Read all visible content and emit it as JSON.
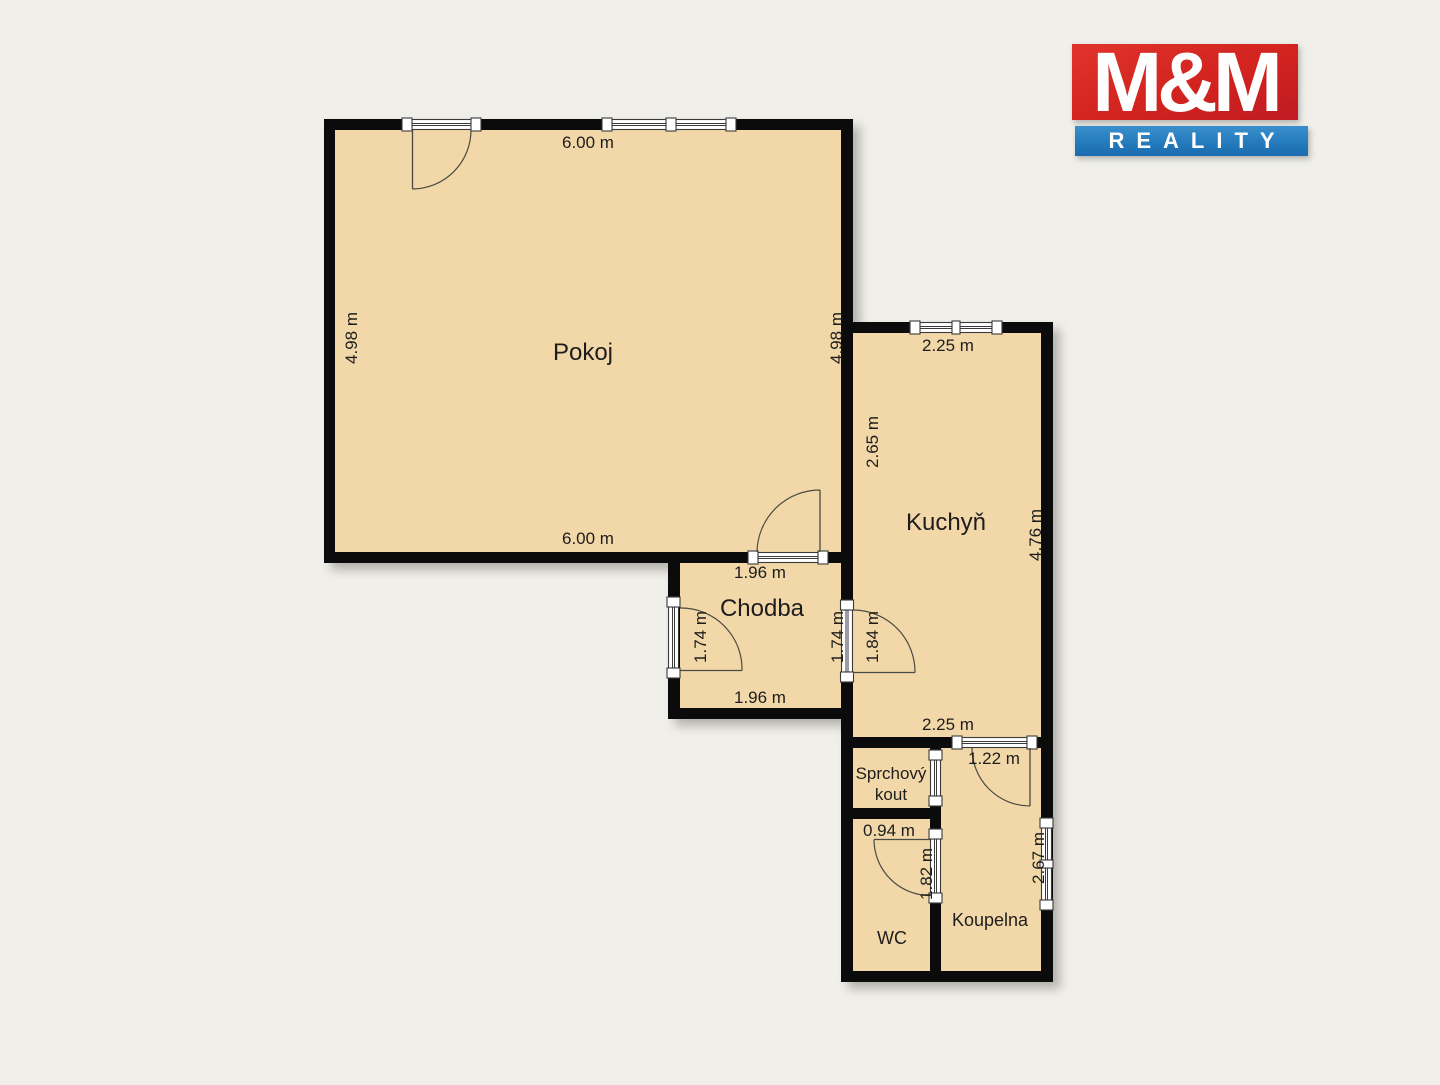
{
  "logo": {
    "title": "M&M",
    "subtitle": "REALITY",
    "red_color": "#d2231f",
    "blue_color": "#2379bb"
  },
  "colors": {
    "background": "#f0efe9",
    "floor": "#f2d8a8",
    "wall": "#0b0b0b",
    "text": "#1d1d1d"
  },
  "rooms": {
    "pokoj": {
      "name": "Pokoj",
      "dim_top": "6.00 m",
      "dim_bottom": "6.00 m",
      "dim_left": "4.98 m",
      "dim_right": "4.98 m"
    },
    "kuchyn": {
      "name": "Kuchyň",
      "dim_top": "2.25 m",
      "dim_bottom": "2.25 m",
      "dim_left_upper": "2.65 m",
      "dim_left_lower": "1.84 m",
      "dim_right": "4.76 m"
    },
    "chodba": {
      "name": "Chodba",
      "dim_top": "1.96 m",
      "dim_bottom": "1.96 m",
      "dim_left": "1.74 m",
      "dim_right": "1.74 m"
    },
    "sprchovy_kout": {
      "name_line1": "Sprchový",
      "name_line2": "kout"
    },
    "wc": {
      "name": "WC",
      "dim_top": "0.94 m",
      "dim_side": "1.82 m"
    },
    "koupelna": {
      "name": "Koupelna",
      "dim_top": "1.22 m",
      "dim_right": "2.67 m"
    }
  }
}
